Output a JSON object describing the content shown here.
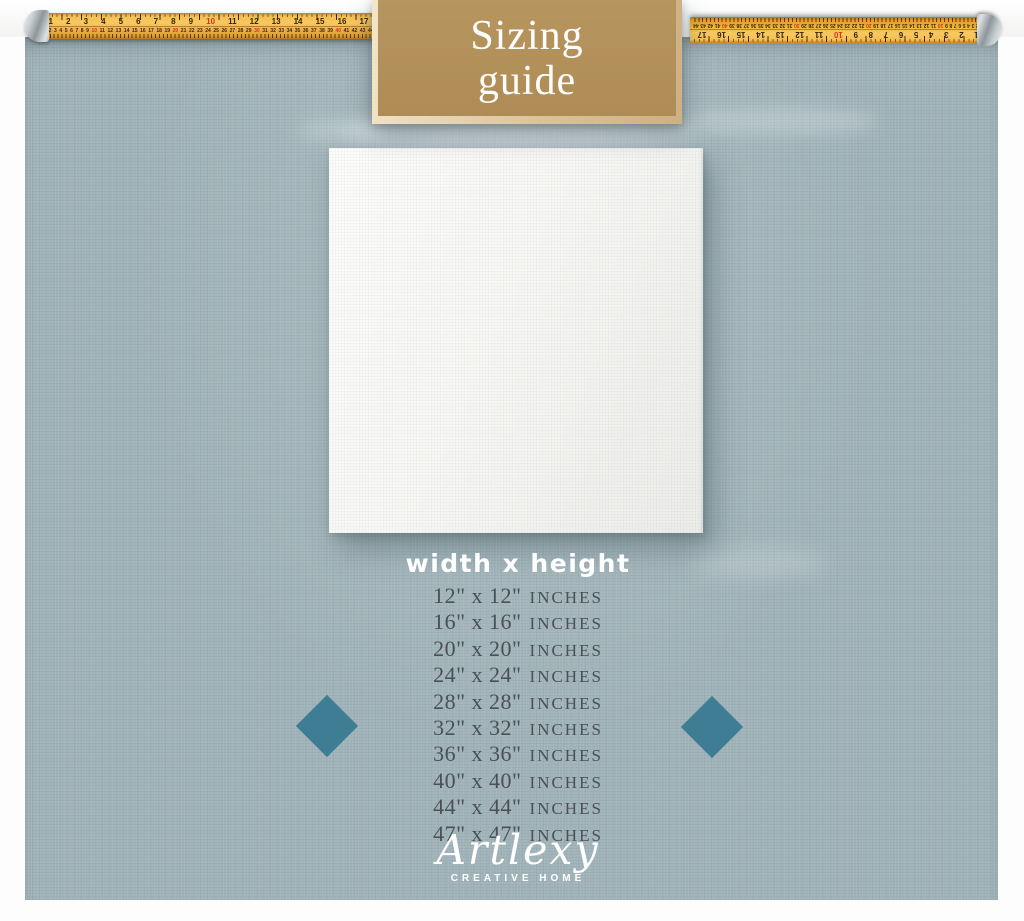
{
  "title_box": {
    "line1": "Sizing",
    "line2": "guide"
  },
  "tape": {
    "inch_numbers": [
      "1",
      "2",
      "3",
      "4",
      "5",
      "6",
      "7",
      "8",
      "9",
      "10",
      "11",
      "12",
      "13",
      "14",
      "15",
      "16",
      "17"
    ],
    "red_inch_numbers": [
      "10"
    ],
    "cm_numbers": [
      "1",
      "2",
      "3",
      "4",
      "5",
      "6",
      "7",
      "8",
      "9",
      "10",
      "11",
      "12",
      "13",
      "14",
      "15",
      "16",
      "17",
      "18",
      "19",
      "20",
      "21",
      "22",
      "23",
      "24",
      "25",
      "26",
      "27",
      "28",
      "29",
      "30",
      "31",
      "32",
      "33",
      "34",
      "35",
      "36",
      "37",
      "38",
      "39",
      "40",
      "41",
      "42",
      "43",
      "44"
    ],
    "red_cm_numbers": [
      "10",
      "20",
      "30",
      "40"
    ]
  },
  "size_guide": {
    "heading": "width x height",
    "sizes": [
      {
        "dims": "12\" x 12\"",
        "unit": "INCHES"
      },
      {
        "dims": "16\" x 16\"",
        "unit": "INCHES"
      },
      {
        "dims": "20\" x 20\"",
        "unit": "INCHES"
      },
      {
        "dims": "24\" x 24\"",
        "unit": "INCHES"
      },
      {
        "dims": "28\" x 28\"",
        "unit": "INCHES"
      },
      {
        "dims": "32\" x 32\"",
        "unit": "INCHES"
      },
      {
        "dims": "36\" x 36\"",
        "unit": "INCHES"
      },
      {
        "dims": "40\" x 40\"",
        "unit": "INCHES"
      },
      {
        "dims": "44\" x 44\"",
        "unit": "INCHES"
      },
      {
        "dims": "47\" x 47\"",
        "unit": "INCHES"
      }
    ]
  },
  "logo": {
    "brand": "Artlexy",
    "tagline": "CREATIVE HOME"
  },
  "colors": {
    "background_linen": "#a1b4b9",
    "title_box_tan": "#b3935d",
    "title_box_border": "#ddc49c",
    "tape_yellow": "#f2b848",
    "tape_red_mark": "#cf3a1b",
    "canvas_white": "#f6f6f4",
    "list_text": "#4a5055",
    "diamond_teal": "#3e7d94",
    "white_text": "#ffffff"
  }
}
